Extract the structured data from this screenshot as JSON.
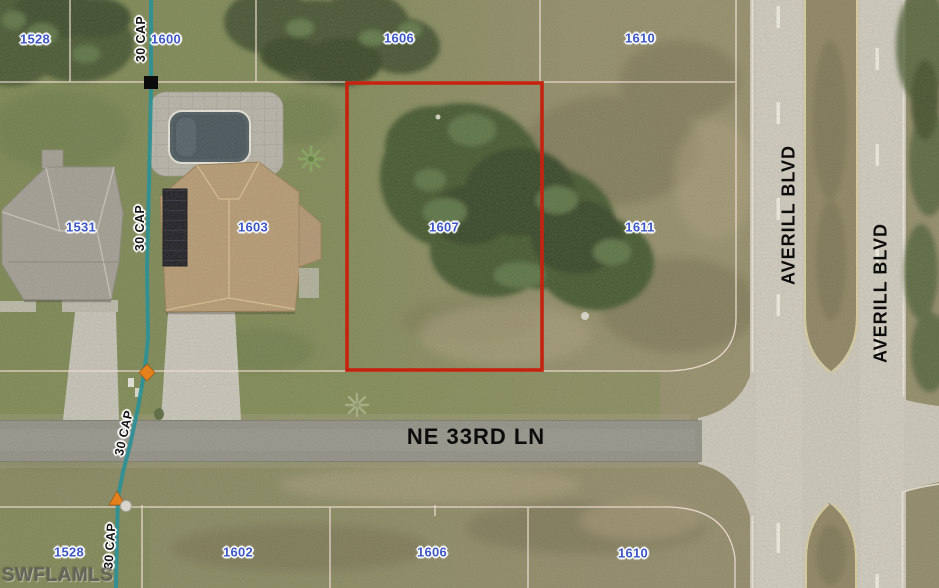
{
  "map_overlay": {
    "watermark": "SWFLAMLS",
    "streets": {
      "ne_33rd_ln": "NE 33RD LN",
      "averill_blvd_west": "AVERILL BLVD",
      "averill_blvd_east": "AVERILL BLVD"
    },
    "utility_labels": [
      "30 CAP",
      "30 CAP",
      "30 CAP",
      "30 CAP"
    ],
    "parcel_numbers": {
      "top_row": [
        "1528",
        "1600",
        "1606",
        "1610"
      ],
      "middle_row": [
        "1531",
        "1603",
        "1607",
        "1611"
      ],
      "bottom_row": [
        "1528",
        "1602",
        "1606",
        "1610"
      ]
    },
    "highlighted_parcel": "1607",
    "colors": {
      "parcel_label": "#3c57c5",
      "highlight_outline": "#c52310",
      "utility_line": "#2f9095",
      "parcel_line": "#f2ded6"
    }
  }
}
